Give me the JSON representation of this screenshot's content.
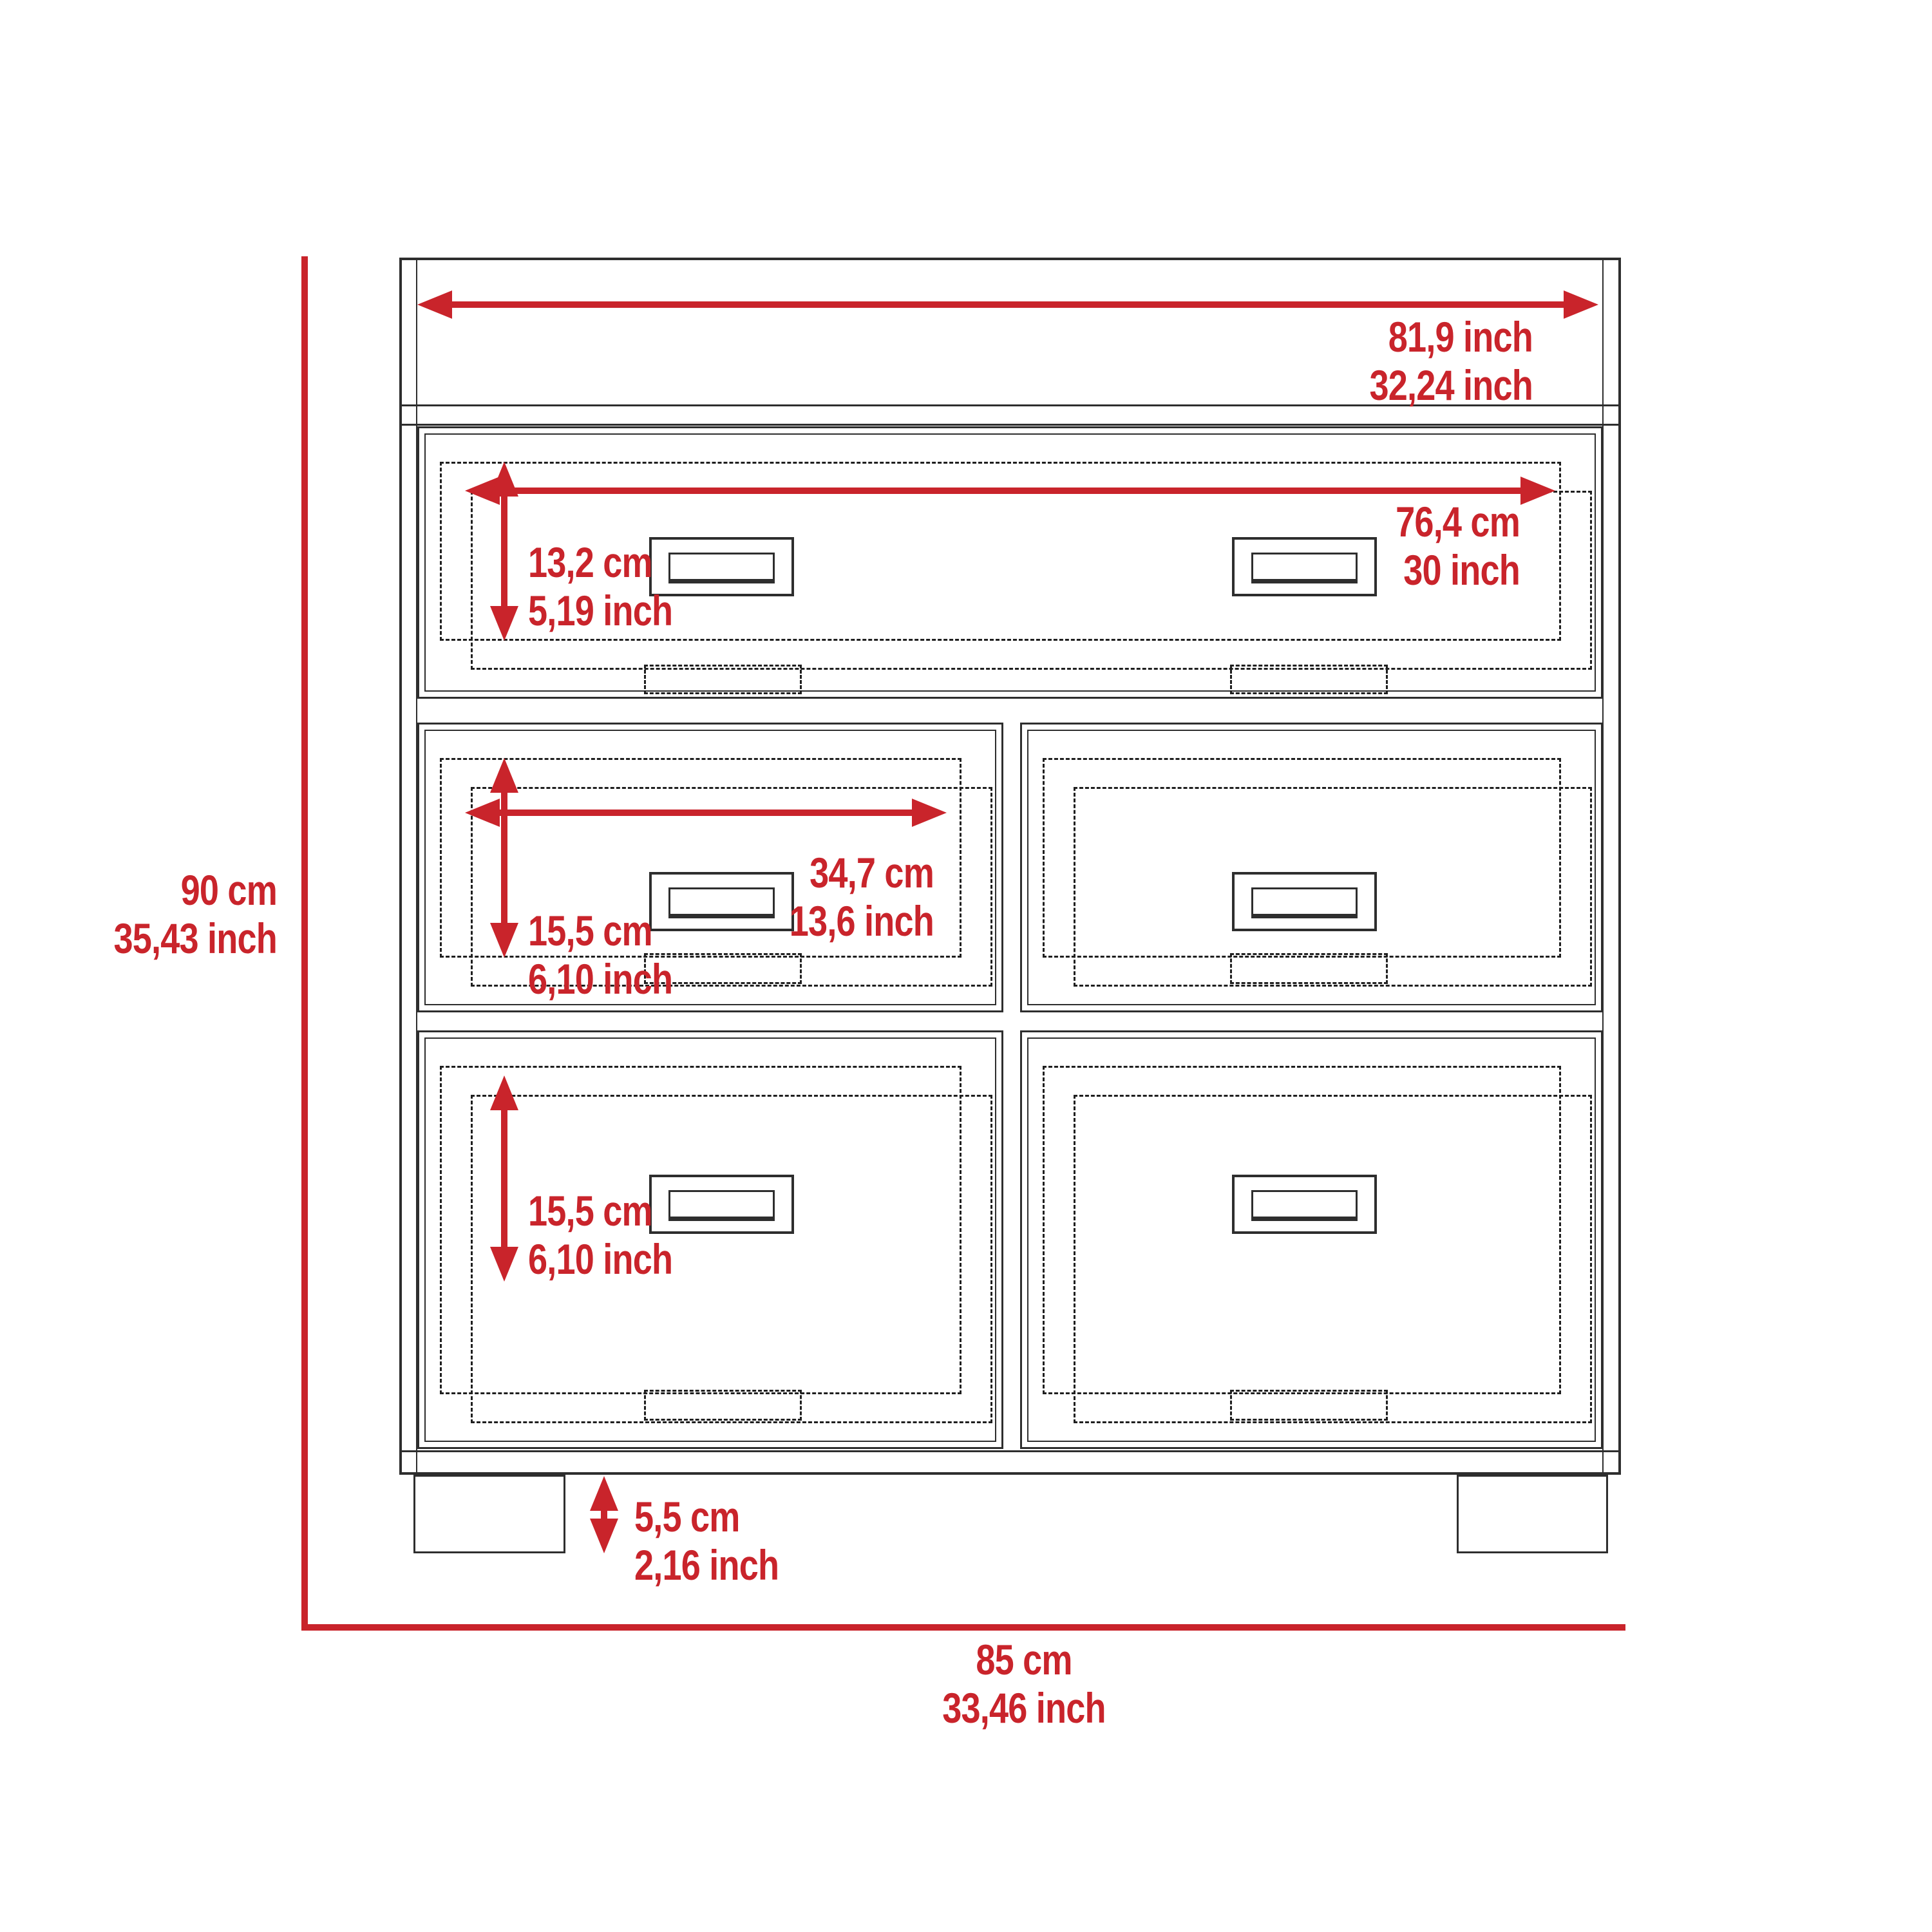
{
  "diagram": {
    "title": "dresser-dimension-drawing",
    "accent_color": "#c9242b",
    "line_color": "#2e2e2e",
    "dims": {
      "overall_height": {
        "cm": "90 cm",
        "inch": "35,43 inch"
      },
      "overall_width": {
        "cm": "85 cm",
        "inch": "33,46 inch"
      },
      "top_width": {
        "cm": "81,9 inch",
        "inch": "32,24 inch"
      },
      "top_drawer_width": {
        "cm": "76,4 cm",
        "inch": "30 inch"
      },
      "top_drawer_height": {
        "cm": "13,2 cm",
        "inch": "5,19 inch"
      },
      "mid_drawer_width": {
        "cm": "34,7 cm",
        "inch": "13,6 inch"
      },
      "mid_drawer_height": {
        "cm": "15,5 cm",
        "inch": "6,10 inch"
      },
      "bottom_drawer_height": {
        "cm": "15,5 cm",
        "inch": "6,10 inch"
      },
      "leg_height": {
        "cm": "5,5 cm",
        "inch": "2,16 inch"
      }
    }
  }
}
